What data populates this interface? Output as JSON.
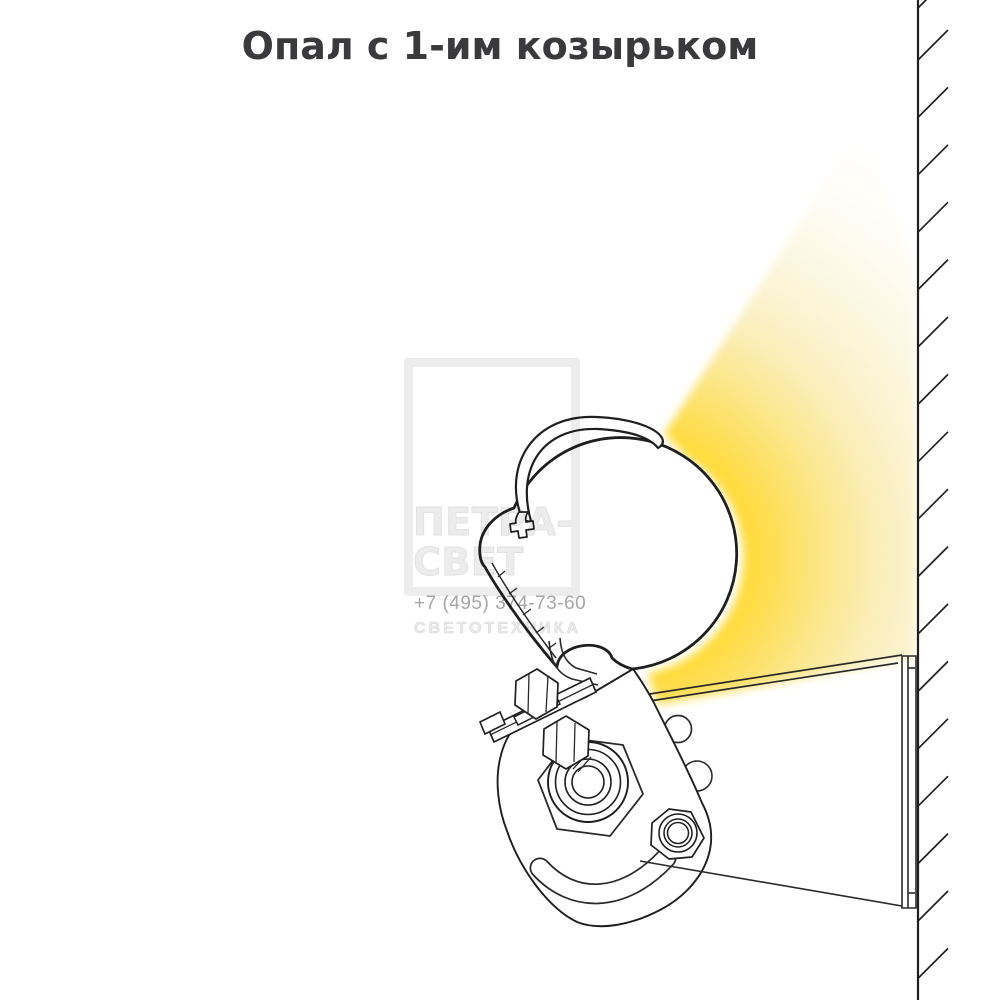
{
  "title": {
    "text": "Опал с 1-им козырьком",
    "color": "#3A3A3C"
  },
  "watermark": {
    "brand_line1": "ПЕТРА-",
    "brand_line2": "СВЕТ",
    "phone": "+7 (495) 374-73-60",
    "tagline": "СВЕТОТЕХНИКА"
  },
  "diagram": {
    "beam": {
      "core_color": "#FFDB3D",
      "fade_color": "#FFFFFF"
    },
    "line_color": "#1F1F1F",
    "background": "#FFFFFF",
    "parts": [
      "opal-diffuser-globe",
      "single-visor",
      "mounting-bracket",
      "pivot-bolt",
      "adjustment-slot",
      "wall-arm",
      "wall-plate",
      "hatched-wall"
    ]
  }
}
